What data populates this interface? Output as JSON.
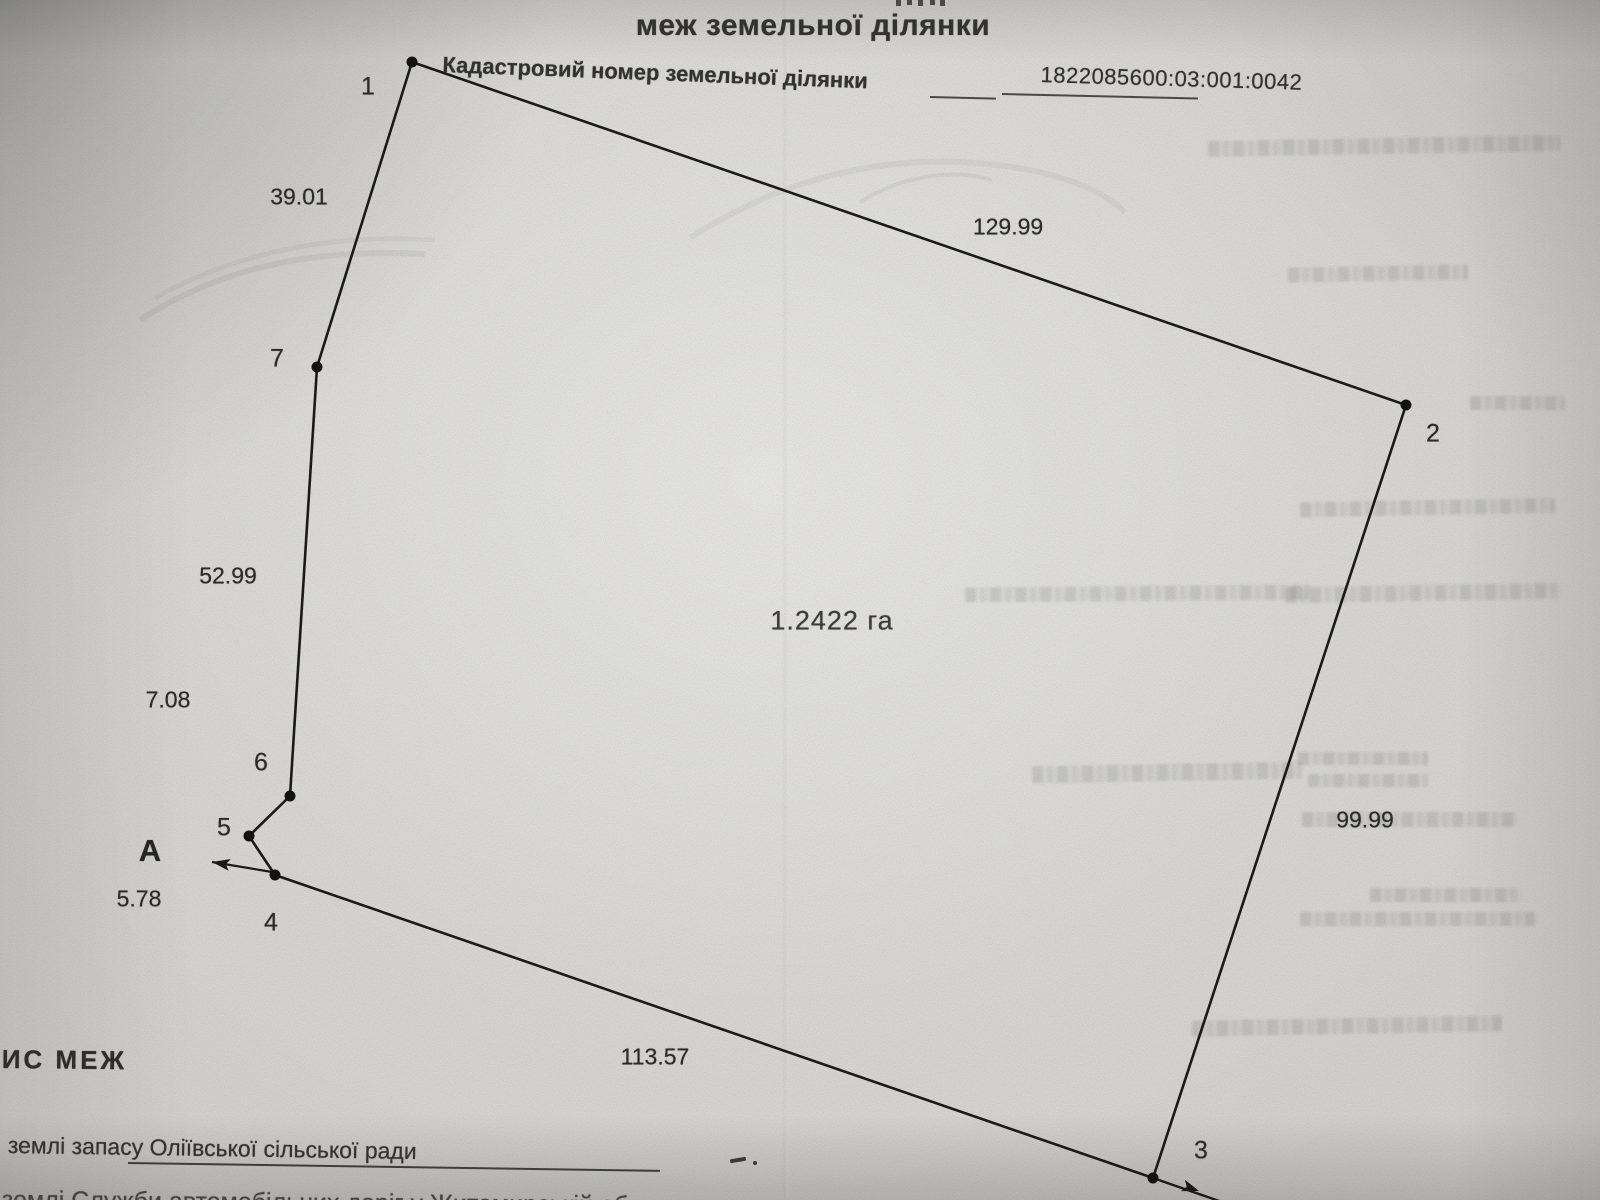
{
  "page": {
    "title_line": "меж земельної ділянки",
    "cadastral_label": "Кадастровий номер земельної ділянки",
    "cadastral_number": "1822085600:03:001:0042",
    "bottom_heading": "ИС МЕЖ",
    "bottom_line1": "землі запасу Оліївської сільської ради",
    "bottom_line2_partial": "землі  Служби автомобільних доріг у Житомирській об"
  },
  "colors": {
    "ink": "#1a1a1a",
    "paper": "#d7d6d4"
  },
  "plan": {
    "area_label": "1.2422 га",
    "area_label_x": 832,
    "area_label_y": 621,
    "direction_marker": {
      "letter": "А",
      "x": 150,
      "y": 851,
      "arrow_from": {
        "x": 272,
        "y": 872
      },
      "arrow_to": {
        "x": 212,
        "y": 862
      }
    },
    "outline_order": [
      "1",
      "7",
      "6",
      "5",
      "4",
      "3",
      "2"
    ],
    "vertices": [
      {
        "n": "1",
        "x": 412,
        "y": 62,
        "label_x": 368,
        "label_y": 87
      },
      {
        "n": "2",
        "x": 1406,
        "y": 405,
        "label_x": 1433,
        "label_y": 434
      },
      {
        "n": "3",
        "x": 1153,
        "y": 1178,
        "label_x": 1201,
        "label_y": 1151
      },
      {
        "n": "4",
        "x": 275,
        "y": 875,
        "label_x": 271,
        "label_y": 923
      },
      {
        "n": "5",
        "x": 249,
        "y": 836,
        "label_x": 224,
        "label_y": 828
      },
      {
        "n": "6",
        "x": 290,
        "y": 796,
        "label_x": 261,
        "label_y": 763
      },
      {
        "n": "7",
        "x": 317,
        "y": 367,
        "label_x": 277,
        "label_y": 359
      }
    ],
    "sides": [
      {
        "from": "1",
        "to": "7",
        "length": "39.01",
        "label_x": 299,
        "label_y": 197
      },
      {
        "from": "7",
        "to": "6",
        "length": "52.99",
        "label_x": 228,
        "label_y": 576
      },
      {
        "from": "6",
        "to": "5",
        "length": "7.08",
        "label_x": 168,
        "label_y": 700
      },
      {
        "from": "5",
        "to": "4",
        "length": "5.78",
        "label_x": 139,
        "label_y": 899
      },
      {
        "from": "4",
        "to": "3",
        "length": "113.57",
        "label_x": 655,
        "label_y": 1057
      },
      {
        "from": "3",
        "to": "2",
        "length": "99.99",
        "label_x": 1365,
        "label_y": 820
      },
      {
        "from": "2",
        "to": "1",
        "length": "129.99",
        "label_x": 1008,
        "label_y": 227
      }
    ],
    "extension_beyond_3": {
      "x": 1222,
      "y": 1202,
      "arrow_x": 1199,
      "arrow_y": 1191
    }
  }
}
